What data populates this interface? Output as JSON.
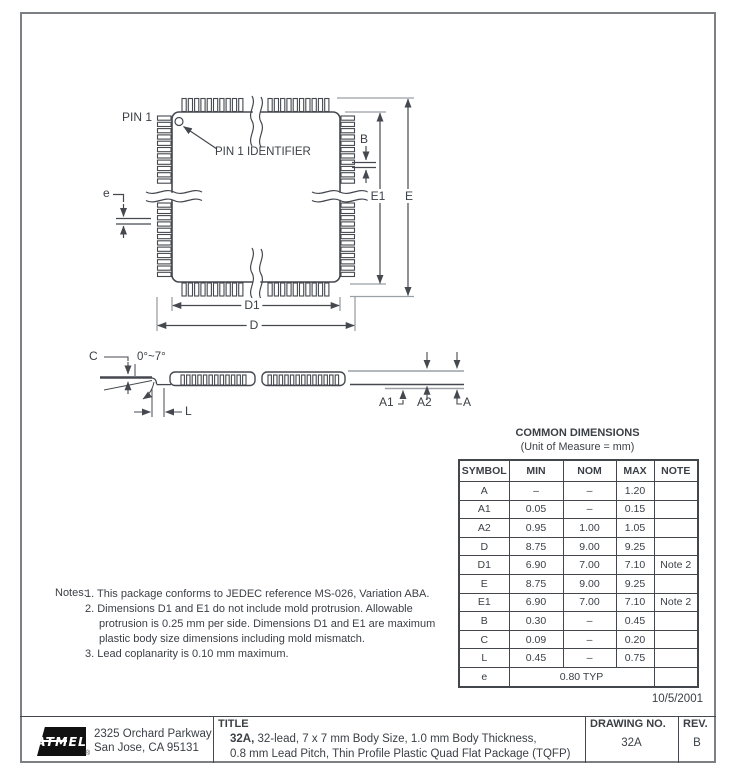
{
  "frame": {
    "date": "10/5/2001"
  },
  "top_view": {
    "pin1": "PIN 1",
    "pin1_identifier": "PIN 1 IDENTIFIER",
    "dim_b": "B",
    "dim_e1": "E1",
    "dim_e": "E",
    "dim_pitch": "e",
    "dim_d1": "D1",
    "dim_d": "D"
  },
  "side_view": {
    "dim_c": "C",
    "angle": "0°~7°",
    "dim_l": "L",
    "dim_a1": "A1",
    "dim_a2": "A2",
    "dim_a": "A"
  },
  "table": {
    "title": "COMMON DIMENSIONS",
    "subtitle": "(Unit of Measure = mm)",
    "columns": [
      "SYMBOL",
      "MIN",
      "NOM",
      "MAX",
      "NOTE"
    ],
    "rows": [
      [
        "A",
        "–",
        "–",
        "1.20",
        ""
      ],
      [
        "A1",
        "0.05",
        "–",
        "0.15",
        ""
      ],
      [
        "A2",
        "0.95",
        "1.00",
        "1.05",
        ""
      ],
      [
        "D",
        "8.75",
        "9.00",
        "9.25",
        ""
      ],
      [
        "D1",
        "6.90",
        "7.00",
        "7.10",
        "Note 2"
      ],
      [
        "E",
        "8.75",
        "9.00",
        "9.25",
        ""
      ],
      [
        "E1",
        "6.90",
        "7.00",
        "7.10",
        "Note 2"
      ],
      [
        "B",
        "0.30",
        "–",
        "0.45",
        ""
      ],
      [
        "C",
        "0.09",
        "–",
        "0.20",
        ""
      ],
      [
        "L",
        "0.45",
        "–",
        "0.75",
        ""
      ]
    ],
    "e_row": {
      "symbol": "e",
      "value": "0.80 TYP",
      "note": ""
    }
  },
  "notes": {
    "label": "Notes:",
    "items": [
      "1. This package conforms to JEDEC reference MS-026, Variation ABA.",
      "2. Dimensions D1 and E1 do not include mold protrusion.  Allowable protrusion is 0.25 mm per side.  Dimensions D1 and E1 are maximum plastic body size dimensions including mold mismatch.",
      "3. Lead coplanarity is 0.10 mm maximum."
    ]
  },
  "title_block": {
    "logo_text": "ATMEL",
    "reg_mark": "®",
    "address_line1": "2325 Orchard Parkway",
    "address_line2": "San Jose, CA  95131",
    "title_label": "TITLE",
    "title_bold": "32A,",
    "title_rest": " 32-lead, 7 x 7 mm Body Size, 1.0 mm Body Thickness,",
    "title_line2": "0.8 mm Lead Pitch, Thin Profile Plastic Quad Flat Package (TQFP)",
    "drawing_no_label": "DRAWING NO.",
    "drawing_no": "32A",
    "rev_label": "REV.",
    "rev": "B"
  }
}
